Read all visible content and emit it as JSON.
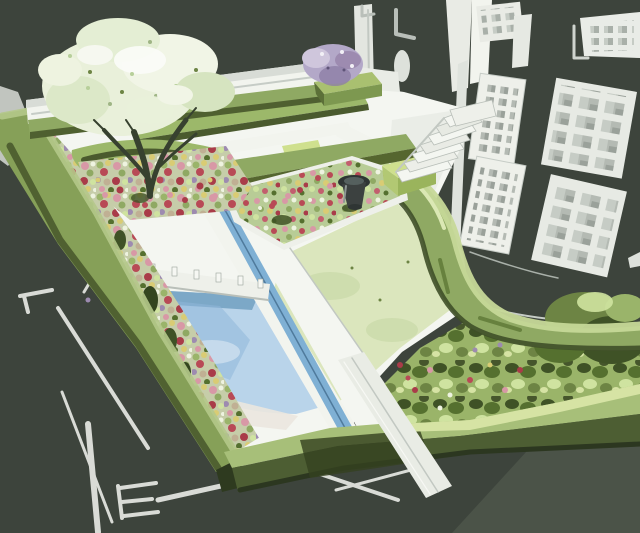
{
  "meta": {
    "type": "illustration",
    "subject": "Watercolor-style concept rendering of a formal walled show garden, aerial three-quarter view, beside a sketched townhouse facade on a dark olive backdrop",
    "medium": "watercolor / posterized sketch",
    "no_visible_text": true
  },
  "palette": {
    "backdrop": "#3d443c",
    "backdrop_light": "#4b5348",
    "paper_white": "#f4f6f1",
    "paper_shade": "#e2e6e0",
    "stone_gray": "#c2c8c2",
    "line_gray": "#9aa29b",
    "sketch_white": "#e7eae4",
    "hedge_highlight": "#c6d898",
    "hedge_light": "#a7bf79",
    "hedge_mid": "#8fa963",
    "hedge_deep": "#6d8444",
    "hedge_dark": "#4a5a2e",
    "hedge_shadow": "#2e3a1f",
    "lawn": "#dbe6bd",
    "lawn_shade": "#c9d9a8",
    "foliage_pale": "#e9f0da",
    "foliage_soft": "#d6e4c0",
    "trunk_brown": "#37412f",
    "pool_light": "#b9d4ea",
    "pool_mid": "#8fb6d8",
    "pool_deep": "#6d9cbe",
    "rill_blue": "#7fb0d4",
    "water_edge": "#5c7e94",
    "bed_base": "#c6cda9",
    "bed_green": "#b8cc96",
    "shrub_base": "#9ab469",
    "flower_pink": "#d898a6",
    "flower_red": "#b84a56",
    "flower_crimson": "#a93c49",
    "flower_yellow": "#d9cc74",
    "flower_mauve": "#9d8bb0",
    "lilac": "#b3a8c8",
    "lilac_deep": "#8d7ea6",
    "soil_tan": "#c0b094",
    "urn_charcoal": "#3c4140",
    "urn_gray": "#8e9694",
    "window_pane": "#a9b0a9",
    "window_pane_light": "#c6ccc5",
    "frame_white": "#edefe9"
  },
  "scene": {
    "background": "dark olive-charcoal studio backdrop",
    "elements": [
      {
        "name": "specimen-tree",
        "desc": "blossoming tree with pale cream-green canopy, top left"
      },
      {
        "name": "back-wall",
        "desc": "white rendered boundary wall behind the garden"
      },
      {
        "name": "wall-hedge",
        "desc": "clipped hedge band at the base of the back wall"
      },
      {
        "name": "seating-area",
        "desc": "L-shaped white bench enclosed by parallel clipped hedges"
      },
      {
        "name": "lilac-shrub",
        "desc": "purple flowering shrub behind the hedge, top centre"
      },
      {
        "name": "central-flower-bed",
        "desc": "island bed of mixed perennials with dark urn sculpture and clipped cube"
      },
      {
        "name": "urn-sculpture",
        "desc": "dark charcoal urn focal point"
      },
      {
        "name": "garden-steps",
        "desc": "white stone steps rising to the glazed doors"
      },
      {
        "name": "curved-hedge",
        "desc": "sweeping S-curved clipped hedge dividing lawn from forecourt"
      },
      {
        "name": "lawn",
        "desc": "pale green oval lawn panel"
      },
      {
        "name": "rill",
        "desc": "narrow blue water rill with white stone margins running diagonally"
      },
      {
        "name": "pool",
        "desc": "light blue pool with crossing white weir bridge"
      },
      {
        "name": "left-flower-border",
        "desc": "wide mixed herbaceous border along the left boundary"
      },
      {
        "name": "boundary-hedge",
        "desc": "outer clipped hedges enclosing the plot on left and bottom"
      },
      {
        "name": "shrub-bed",
        "desc": "bottom-right bed of shrubs and flowers"
      },
      {
        "name": "townhouse-facade",
        "desc": "sketched white building with gridded sash windows and tall glazed doors, right"
      },
      {
        "name": "sketch-lines",
        "desc": "loose white construction lines on the dark ground, lower left"
      }
    ]
  }
}
